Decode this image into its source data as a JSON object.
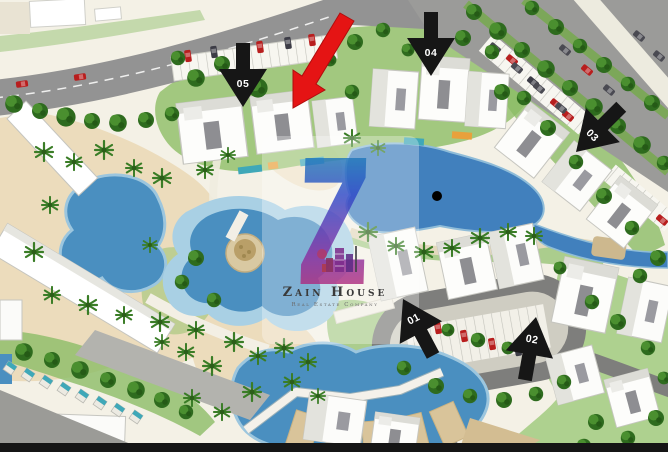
{
  "watermark": {
    "logo_letter": "Z",
    "company_name": "Zain House",
    "tagline": "Real Estate Company"
  },
  "markers": [
    {
      "label": "01",
      "direction": "up-left"
    },
    {
      "label": "02",
      "direction": "up"
    },
    {
      "label": "03",
      "direction": "down-left"
    },
    {
      "label": "04",
      "direction": "down"
    },
    {
      "label": "05",
      "direction": "down"
    }
  ],
  "highlight_arrow": {
    "color": "#e51414",
    "direction": "down-left"
  },
  "location_dot": {
    "color": "#000000"
  },
  "colors": {
    "pool": "#4a8fc0",
    "lagoon": "#4180bd",
    "pool_edge": "#9cc6de",
    "sand": "#ecdcbc",
    "road": "#939393",
    "lawn": "#93c16c",
    "tree": "#2e6b1e",
    "building": "#ffffff",
    "marker_arrow": "#161616",
    "bottom_bar": "#151515",
    "watermark_gradient": [
      "#13a3ae",
      "#2b46c8",
      "#8a2ca0",
      "#e0274c"
    ]
  }
}
